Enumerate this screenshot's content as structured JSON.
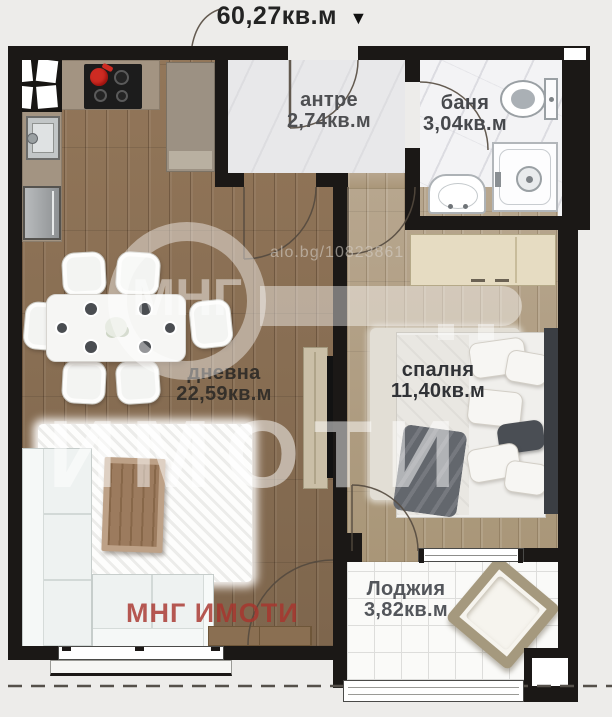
{
  "header": {
    "total_area": "60,27кв.м",
    "arrow_icon": "▼"
  },
  "rooms": [
    {
      "key": "entry",
      "name": "антре",
      "area": "2,74кв.м"
    },
    {
      "key": "bathroom",
      "name": "баня",
      "area": "3,04кв.м"
    },
    {
      "key": "living",
      "name": "дневна",
      "area": "22,59кв.м"
    },
    {
      "key": "bedroom",
      "name": "спалня",
      "area": "11,40кв.м"
    },
    {
      "key": "loggia",
      "name": "Лоджия",
      "area": "3,82кв.м"
    }
  ],
  "watermarks": {
    "listing_ref": "alo.bg/10823861",
    "agency_logo_text": "МНГ",
    "agency_large_text": "ИМОТИ",
    "agency_footer_text": "МНГ ИМОТИ"
  },
  "palette": {
    "wall": "#1b1816",
    "living_wood": "#8d7258",
    "bedroom_wood": "#b3a189",
    "brand_red": "#a83a32",
    "watermark_white": "rgba(255,255,255,0.45)"
  }
}
